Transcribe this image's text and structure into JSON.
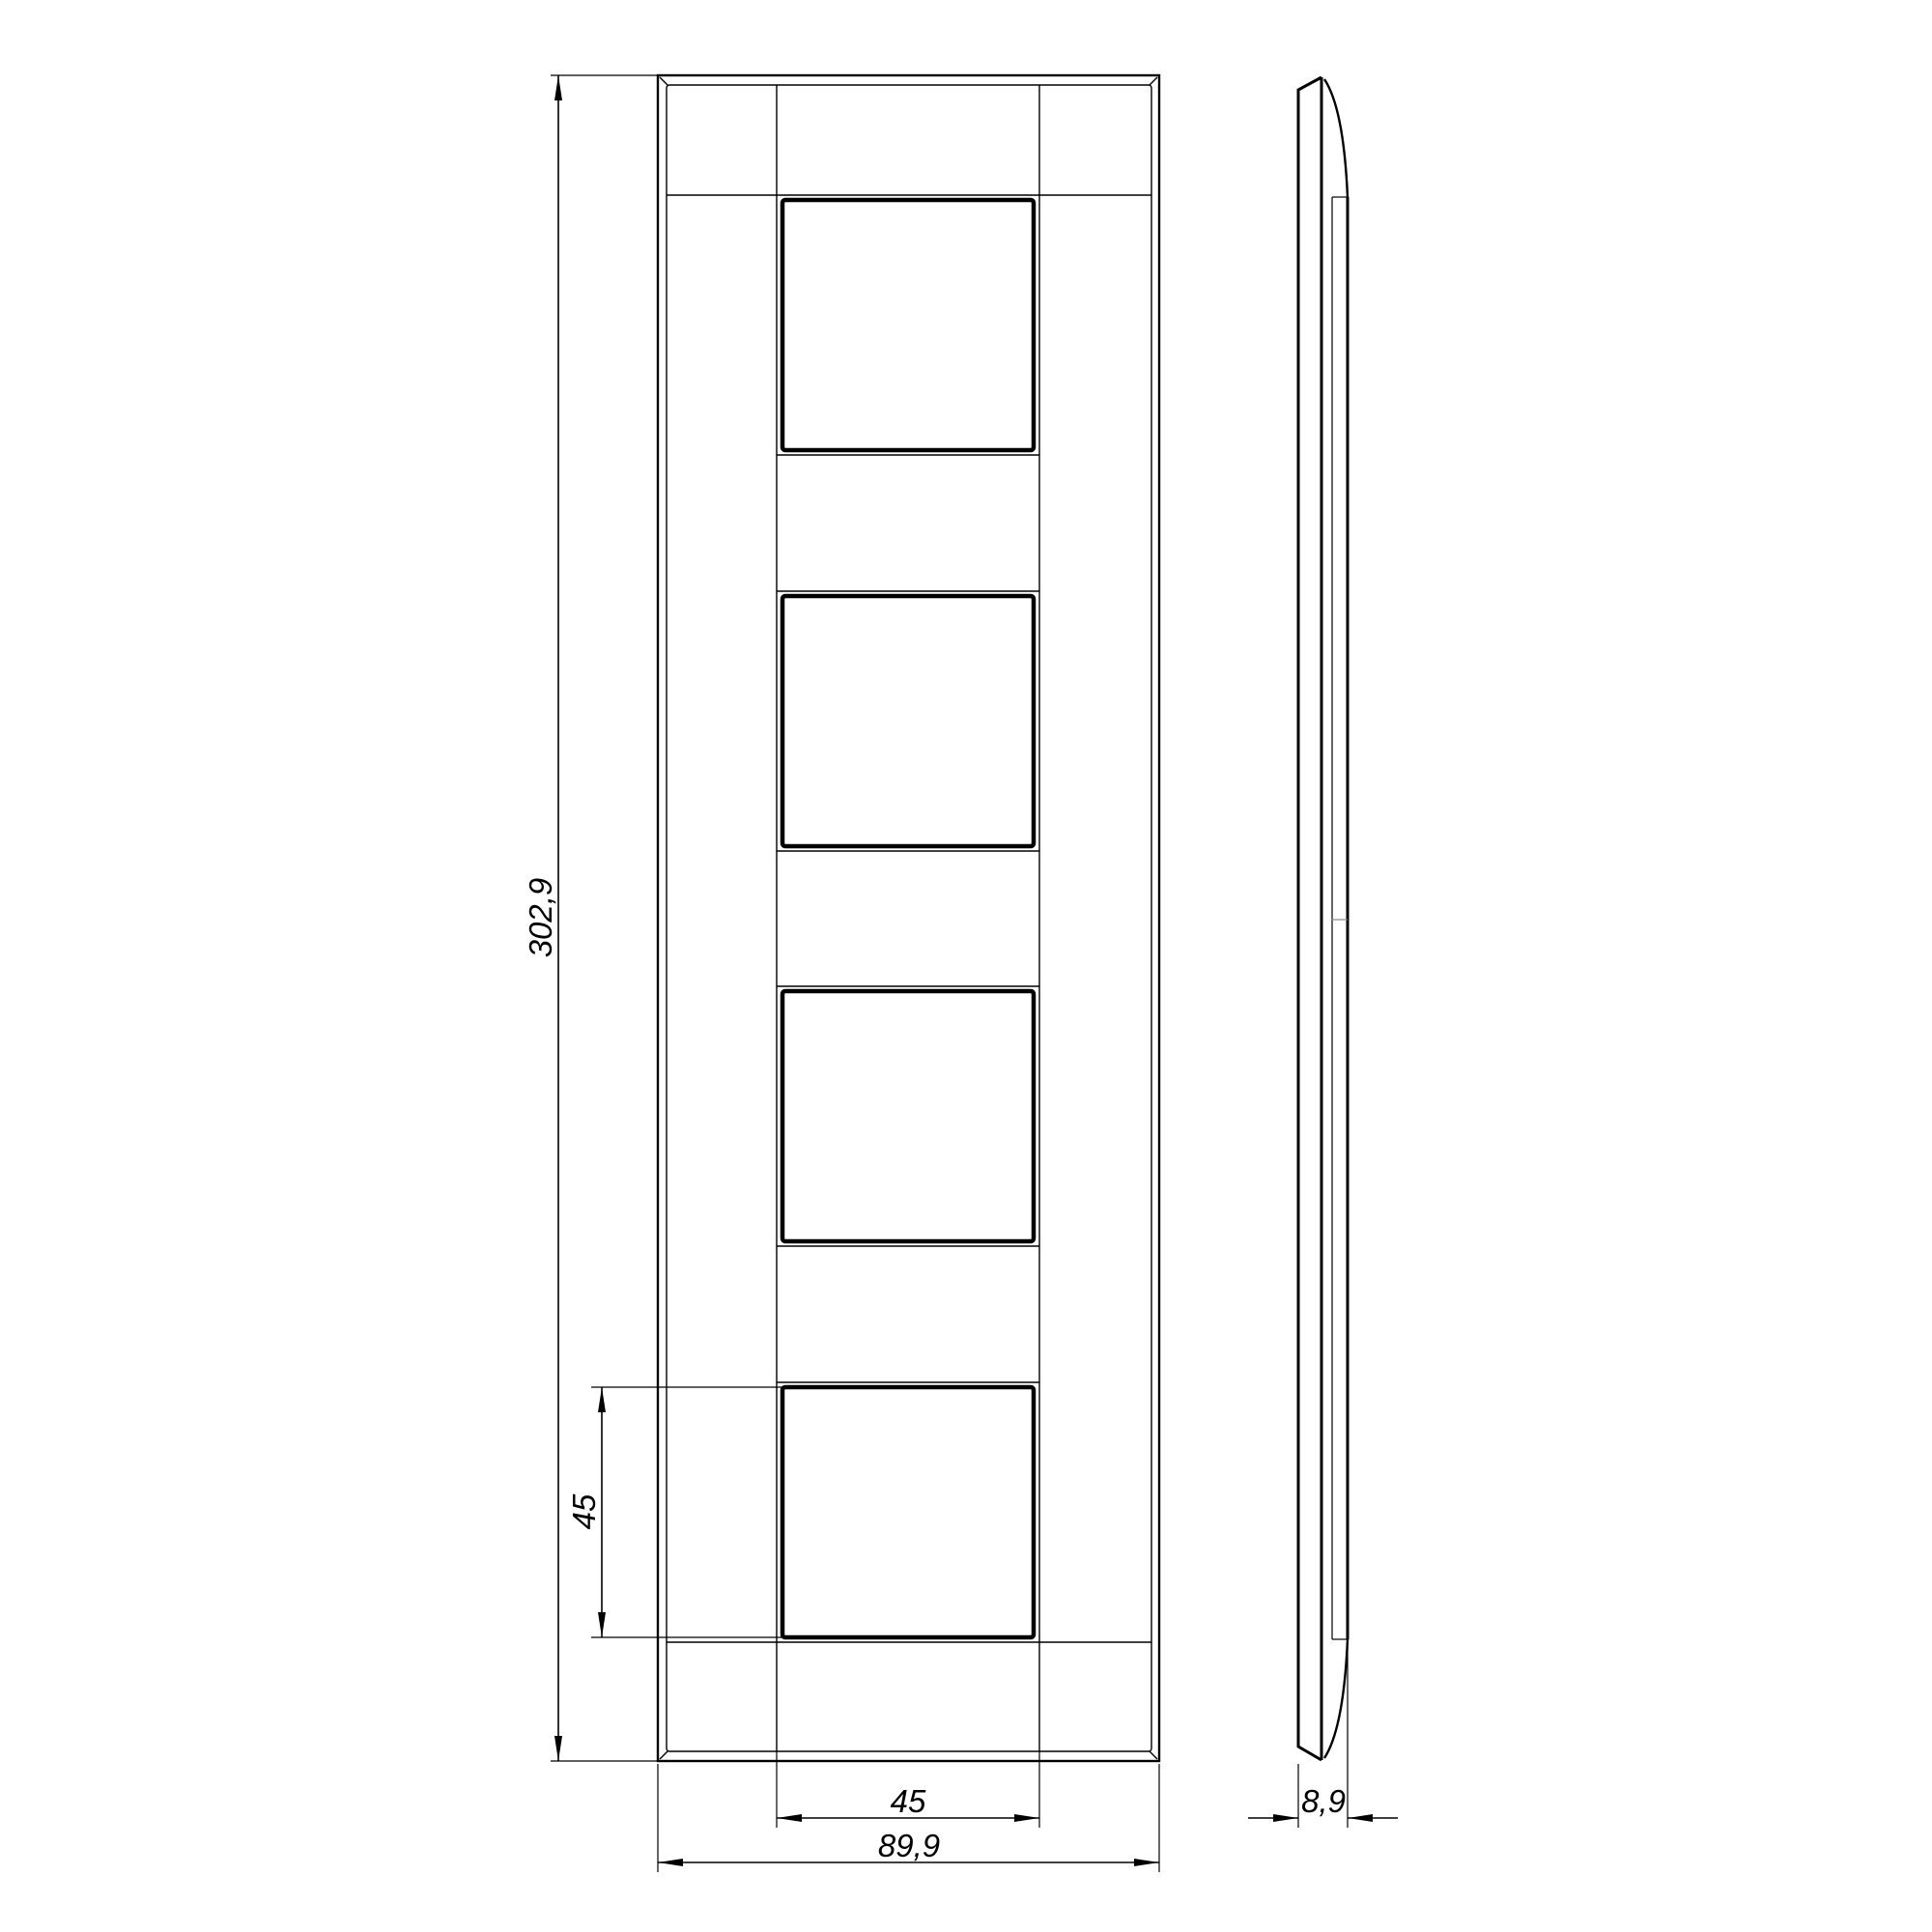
{
  "drawing": {
    "kind": "technical-drawing",
    "subject": "4-gang wall plate frame, orthographic projection (front and side views)",
    "background_color": "#ffffff",
    "line_color": "#000000",
    "front_view": {
      "openings_count": "4"
    },
    "dimensions": {
      "overall_height": {
        "label": "302,9"
      },
      "opening_height": {
        "label": "45"
      },
      "opening_width": {
        "label": "45"
      },
      "overall_width": {
        "label": "89,9"
      },
      "thickness": {
        "label": "8,9"
      }
    }
  }
}
